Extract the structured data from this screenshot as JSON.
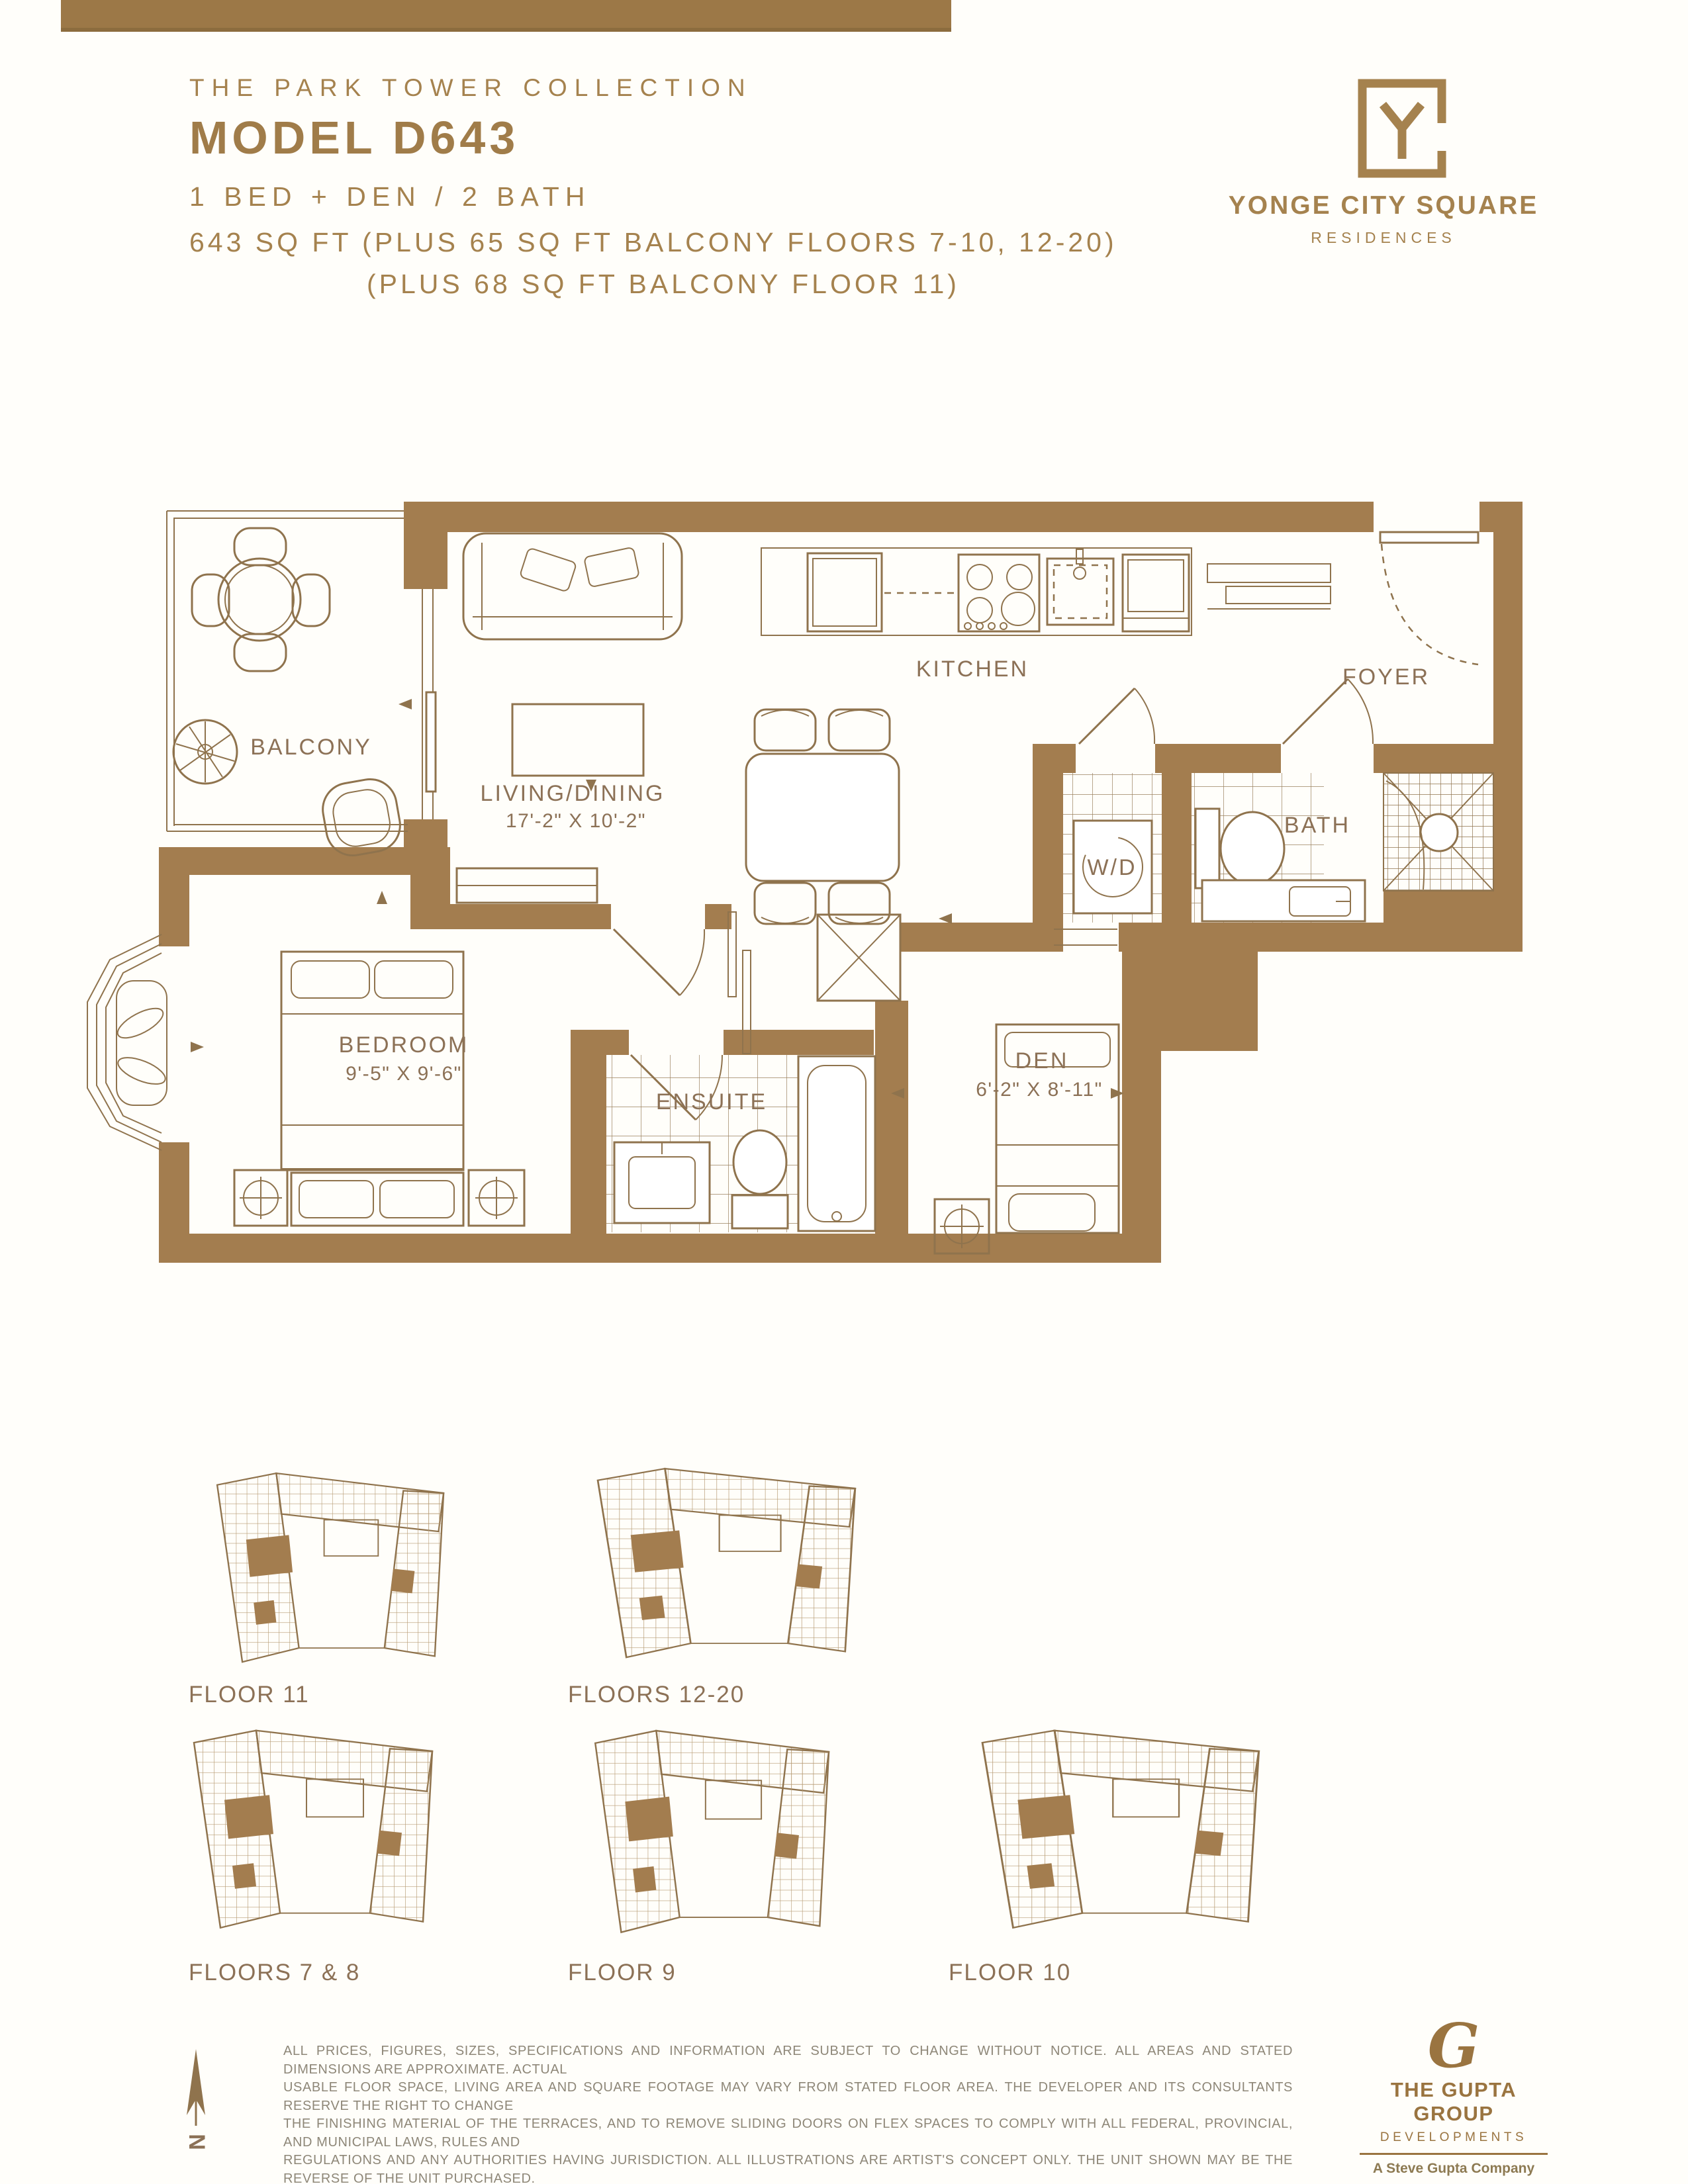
{
  "header": {
    "collection": "THE PARK TOWER COLLECTION",
    "model": "MODEL D643",
    "configuration": "1 BED + DEN / 2 BATH",
    "area_line_1": "643 SQ FT (PLUS 65 SQ FT BALCONY FLOORS 7-10, 12-20)",
    "area_line_2": "(PLUS 68 SQ FT BALCONY FLOOR 11)"
  },
  "brand": {
    "name": "YONGE CITY SQUARE",
    "descriptor": "RESIDENCES"
  },
  "floorplan": {
    "balcony": {
      "label": "BALCONY"
    },
    "living_dining": {
      "label": "LIVING/DINING",
      "dims": "17'-2\" X 10'-2\""
    },
    "kitchen": {
      "label": "KITCHEN"
    },
    "foyer": {
      "label": "FOYER"
    },
    "laundry": {
      "label": "W/D"
    },
    "bath": {
      "label": "BATH"
    },
    "bedroom": {
      "label": "BEDROOM",
      "dims": "9'-5\" X 9'-6\""
    },
    "ensuite": {
      "label": "ENSUITE"
    },
    "den": {
      "label": "DEN",
      "dims": "6'-2\" X 8'-11\""
    }
  },
  "keyplates": [
    {
      "label": "FLOOR 11"
    },
    {
      "label": "FLOORS 12-20"
    },
    {
      "label": "FLOORS 7 & 8"
    },
    {
      "label": "FLOOR 9"
    },
    {
      "label": "FLOOR 10"
    }
  ],
  "compass": {
    "label": "N"
  },
  "disclaimer": {
    "lines": [
      "ALL PRICES, FIGURES, SIZES, SPECIFICATIONS AND INFORMATION ARE SUBJECT TO CHANGE WITHOUT NOTICE. ALL AREAS AND STATED DIMENSIONS ARE APPROXIMATE. ACTUAL",
      "USABLE FLOOR SPACE, LIVING AREA AND SQUARE FOOTAGE MAY VARY FROM STATED FLOOR AREA. THE DEVELOPER AND ITS CONSULTANTS RESERVE THE RIGHT TO CHANGE",
      "THE FINISHING MATERIAL OF THE TERRACES, AND TO REMOVE SLIDING DOORS ON FLEX SPACES TO COMPLY WITH ALL FEDERAL, PROVINCIAL, AND MUNICIPAL LAWS, RULES AND",
      "REGULATIONS AND ANY AUTHORITIES HAVING JURISDICTION. ALL ILLUSTRATIONS ARE ARTIST'S CONCEPT ONLY. THE UNIT SHOWN MAY BE THE REVERSE OF THE UNIT PURCHASED.",
      "THE PURCHASE PRICE DOES NOT INCLUDE ANY FURNITURE. E. & O.E. JULY 2023."
    ]
  },
  "developer": {
    "monogram": "G",
    "name": "THE GUPTA GROUP",
    "division": "DEVELOPMENTS",
    "tagline": "A Steve Gupta Company"
  },
  "colors": {
    "wall": "#a37d4f",
    "line": "#8f734d",
    "gold_text": "#a5824e",
    "label_text": "#8c7156",
    "disclaimer_text": "#8e8778",
    "accent_bar": "#9c7847"
  }
}
